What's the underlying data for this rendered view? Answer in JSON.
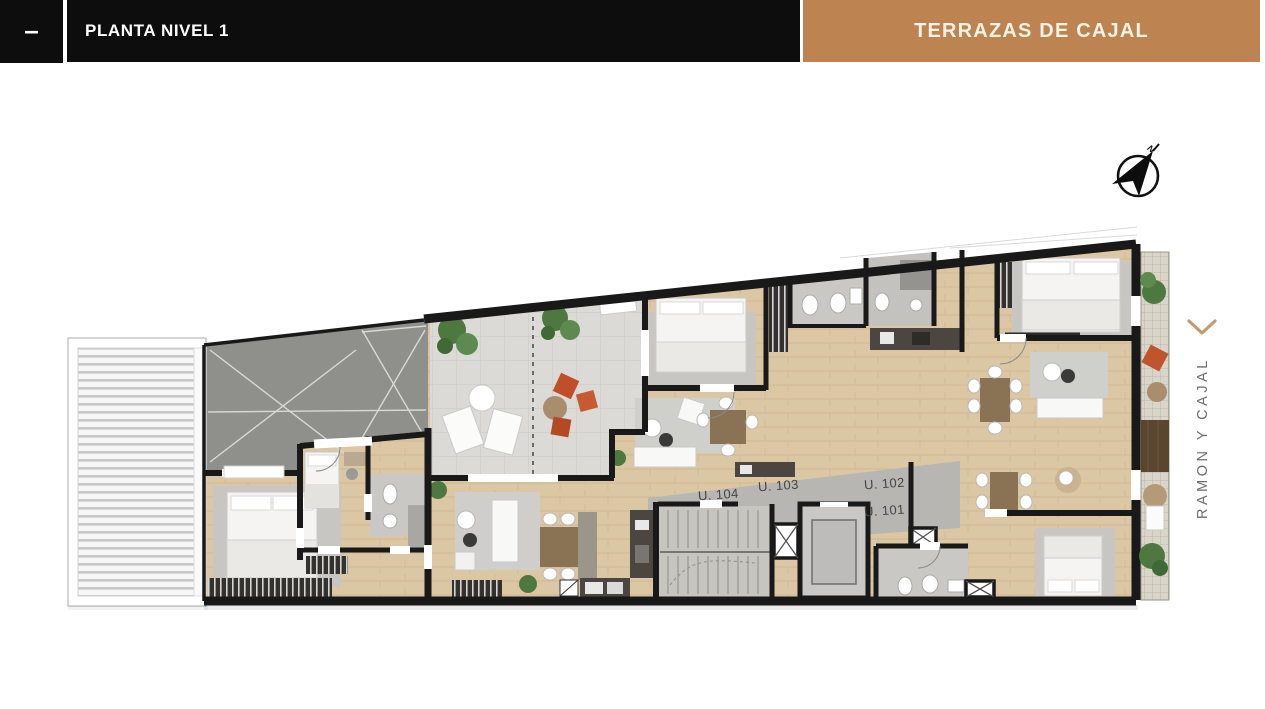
{
  "header": {
    "dash": "–",
    "title": "PLANTA NIVEL 1",
    "project": "TERRAZAS DE CAJAL"
  },
  "compass": {
    "north_label": "N"
  },
  "plan": {
    "level": "PLANTA NIVEL 1",
    "units": [
      {
        "id": "U. 104"
      },
      {
        "id": "U. 103"
      },
      {
        "id": "U. 102"
      },
      {
        "id": "U. 101"
      }
    ],
    "street": {
      "label": "RAMON Y CAJAL"
    }
  },
  "colors": {
    "header_bar": "#0d0d0d",
    "accent_brown": "#bd8350",
    "project_text": "#f8f2e7",
    "wall": "#191919",
    "wood_floor": "#dcc7a5",
    "terrace_tile": "#dbdad6",
    "corridor_gray": "#b7b6b3",
    "void_gray": "#8f8f8c",
    "plant_green": "#4f7a42",
    "pouf_terracotta": "#c0542c",
    "street_text": "#6e6e6e",
    "chevron_tan": "#c49a6c"
  }
}
